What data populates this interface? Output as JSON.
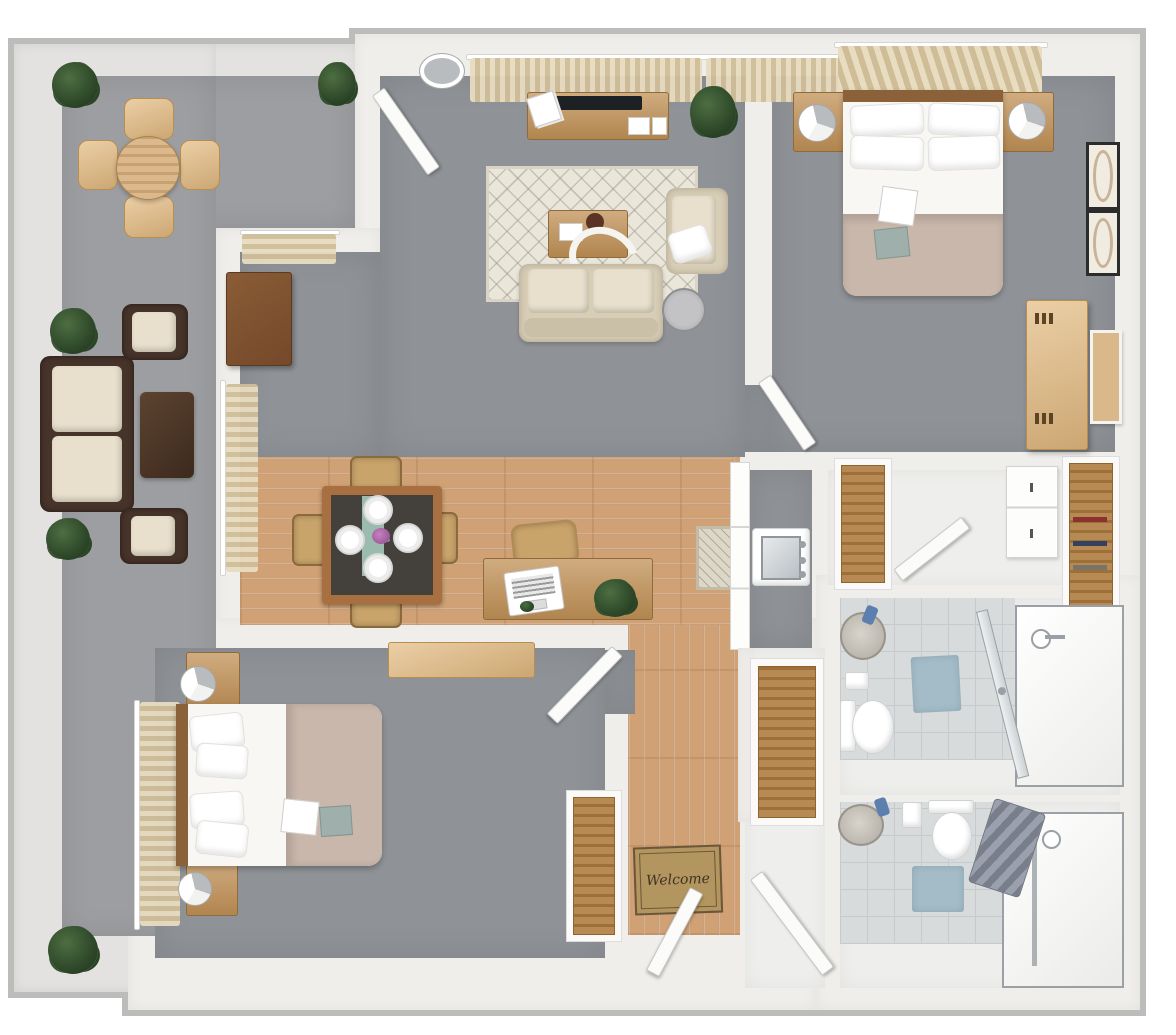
{
  "labels": {
    "welcome_mat": "Welcome"
  },
  "colors": {
    "background": "#ffffff",
    "wall": "#f0eeea",
    "wall_outline": "#bcbcba",
    "patio_wall": "#e3e2e0",
    "patio_floor": "#9c9ea1",
    "carpet": "#8f9397",
    "wood_floor": "#cfa175",
    "tile_floor": "#d8dbdc",
    "tile_line": "#c6cacc",
    "white_floor": "#eeeeec",
    "accent_wood": "#c09055",
    "light_wood": "#e3ba80",
    "dark_wood": "#74492a",
    "dining_wood": "#a87040",
    "table_top": "#44403b",
    "runner_teal": "#a5c9bb",
    "chair_tan": "#c8a36a",
    "wicker": "#46332a",
    "cushion": "#e8e0cc",
    "sofa": "#d8cdb5",
    "rug": "#eae6da",
    "duvet": "#c9b7ab",
    "linen": "#f8f7f4",
    "bed_head": "#8a6138",
    "curtain_light": "#e8dcc1",
    "curtain_dark": "#cfbd98",
    "plant_green": "#2f4a2a",
    "mat_blue": "#a3bcc8",
    "towel_gray": "#868c98",
    "metal": "#9aa0a5",
    "glass": "#ccd1d4",
    "door_white": "#fbfbfa",
    "welcome_mat": "#b2955f",
    "welcome_text": "#3f3322",
    "flower_pink": "#c77fc1"
  },
  "rooms": [
    {
      "id": "patio",
      "items": [
        "round-outdoor-dining-table",
        "4-outdoor-chairs",
        "wicker-sofa",
        "2-wicker-armchairs",
        "wicker-coffee-table",
        "5-potted-plants"
      ]
    },
    {
      "id": "living-room",
      "items": [
        "ceiling-light",
        "window-curtains",
        "tv-console",
        "tv",
        "area-rug",
        "coffee-table",
        "loveseat",
        "armchair",
        "throw-pillow",
        "side-table",
        "corner-cabinet",
        "potted-plant",
        "patio-door"
      ]
    },
    {
      "id": "dining-area",
      "items": [
        "dining-table",
        "4-dining-chairs",
        "4-place-settings",
        "flowers",
        "table-runner",
        "desk",
        "laptop",
        "desk-chair",
        "desk-plant",
        "hall-runner-rug"
      ]
    },
    {
      "id": "bedroom-2",
      "items": [
        "double-bed",
        "4-pillows",
        "duvet",
        "2-nightstands",
        "2-table-lamps",
        "window-curtains",
        "2-wall-art-frames",
        "wardrobe",
        "mirror",
        "door"
      ]
    },
    {
      "id": "closet-hall",
      "items": [
        "utility-sink",
        "cabinets",
        "shelved-closet",
        "white-cabinet",
        "walk-in-closet",
        "open-door"
      ]
    },
    {
      "id": "bathroom-1",
      "items": [
        "vanity-sink",
        "toilet-paper-holder",
        "toilet",
        "bath-mat",
        "glass-shower-door",
        "walk-in-shower",
        "shower-head"
      ]
    },
    {
      "id": "bathroom-2",
      "items": [
        "vanity-sink",
        "toilet-paper-holder",
        "toilet",
        "bath-mat",
        "towels",
        "tub-shower",
        "glass-panel"
      ]
    },
    {
      "id": "bedroom-1",
      "items": [
        "double-bed",
        "4-pillows",
        "duvet",
        "breakfast-tray",
        "book",
        "2-nightstands",
        "2-table-lamps",
        "window-curtains",
        "dresser",
        "shelved-closet",
        "door"
      ]
    },
    {
      "id": "entry",
      "items": [
        "welcome-mat",
        "front-door",
        "hall-door",
        "linen-closet"
      ]
    }
  ]
}
